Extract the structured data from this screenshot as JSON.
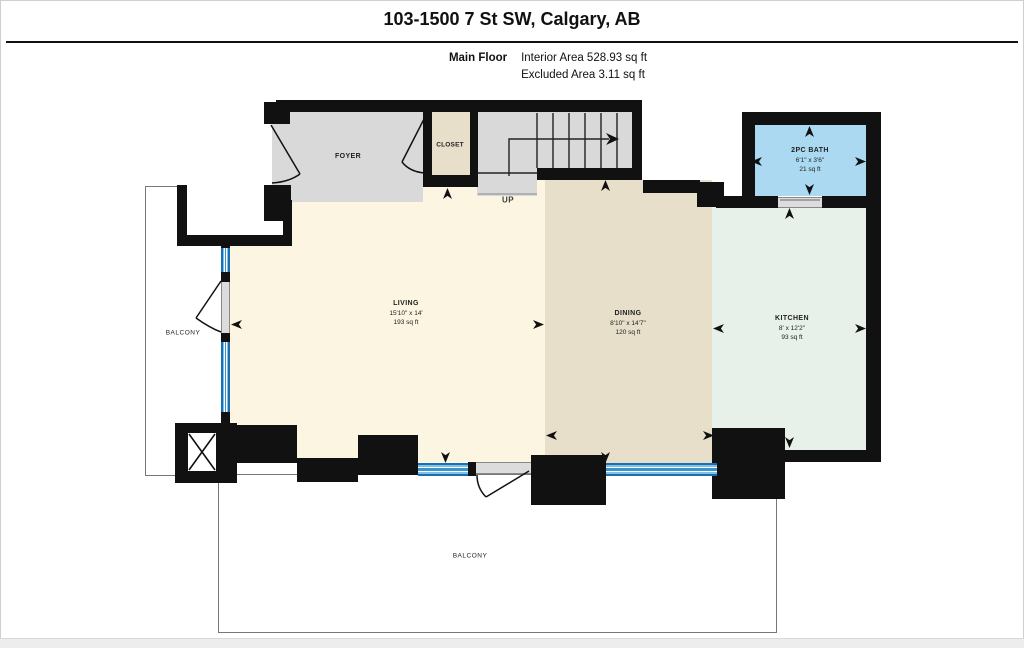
{
  "header": {
    "title": "103-1500 7 St SW, Calgary, AB",
    "floor_label": "Main Floor",
    "interior_area_label": "Interior Area 528.93 sq ft",
    "excluded_area_label": "Excluded Area 3.11 sq ft"
  },
  "rooms": {
    "foyer": {
      "name": "FOYER"
    },
    "closet": {
      "name": "CLOSET"
    },
    "stairs": {
      "direction_label": "UP"
    },
    "bath": {
      "name": "2PC BATH",
      "dimensions": "6'1\" x 3'6\"",
      "area": "21 sq ft"
    },
    "living": {
      "name": "LIVING",
      "dimensions": "15'10\" x 14'",
      "area": "193 sq ft"
    },
    "dining": {
      "name": "DINING",
      "dimensions": "8'10\" x 14'7\"",
      "area": "120 sq ft"
    },
    "kitchen": {
      "name": "KITCHEN",
      "dimensions": "8' x 12'2\"",
      "area": "93 sq ft"
    },
    "balcony_left": {
      "name": "BALCONY"
    },
    "balcony_bottom": {
      "name": "BALCONY"
    }
  },
  "colors": {
    "wall": "#111111",
    "living_fill": "#fcf5e1",
    "dining_fill": "#e8dfca",
    "kitchen_fill": "#e8f0ea",
    "bath_fill": "#abd9f2",
    "foyer_fill": "#d9d9d9",
    "closet_fill": "#e8dfca",
    "stairs_fill": "#d9d9d9",
    "window_blue": "#4d9fd4",
    "balcony_outline": "#777777"
  }
}
